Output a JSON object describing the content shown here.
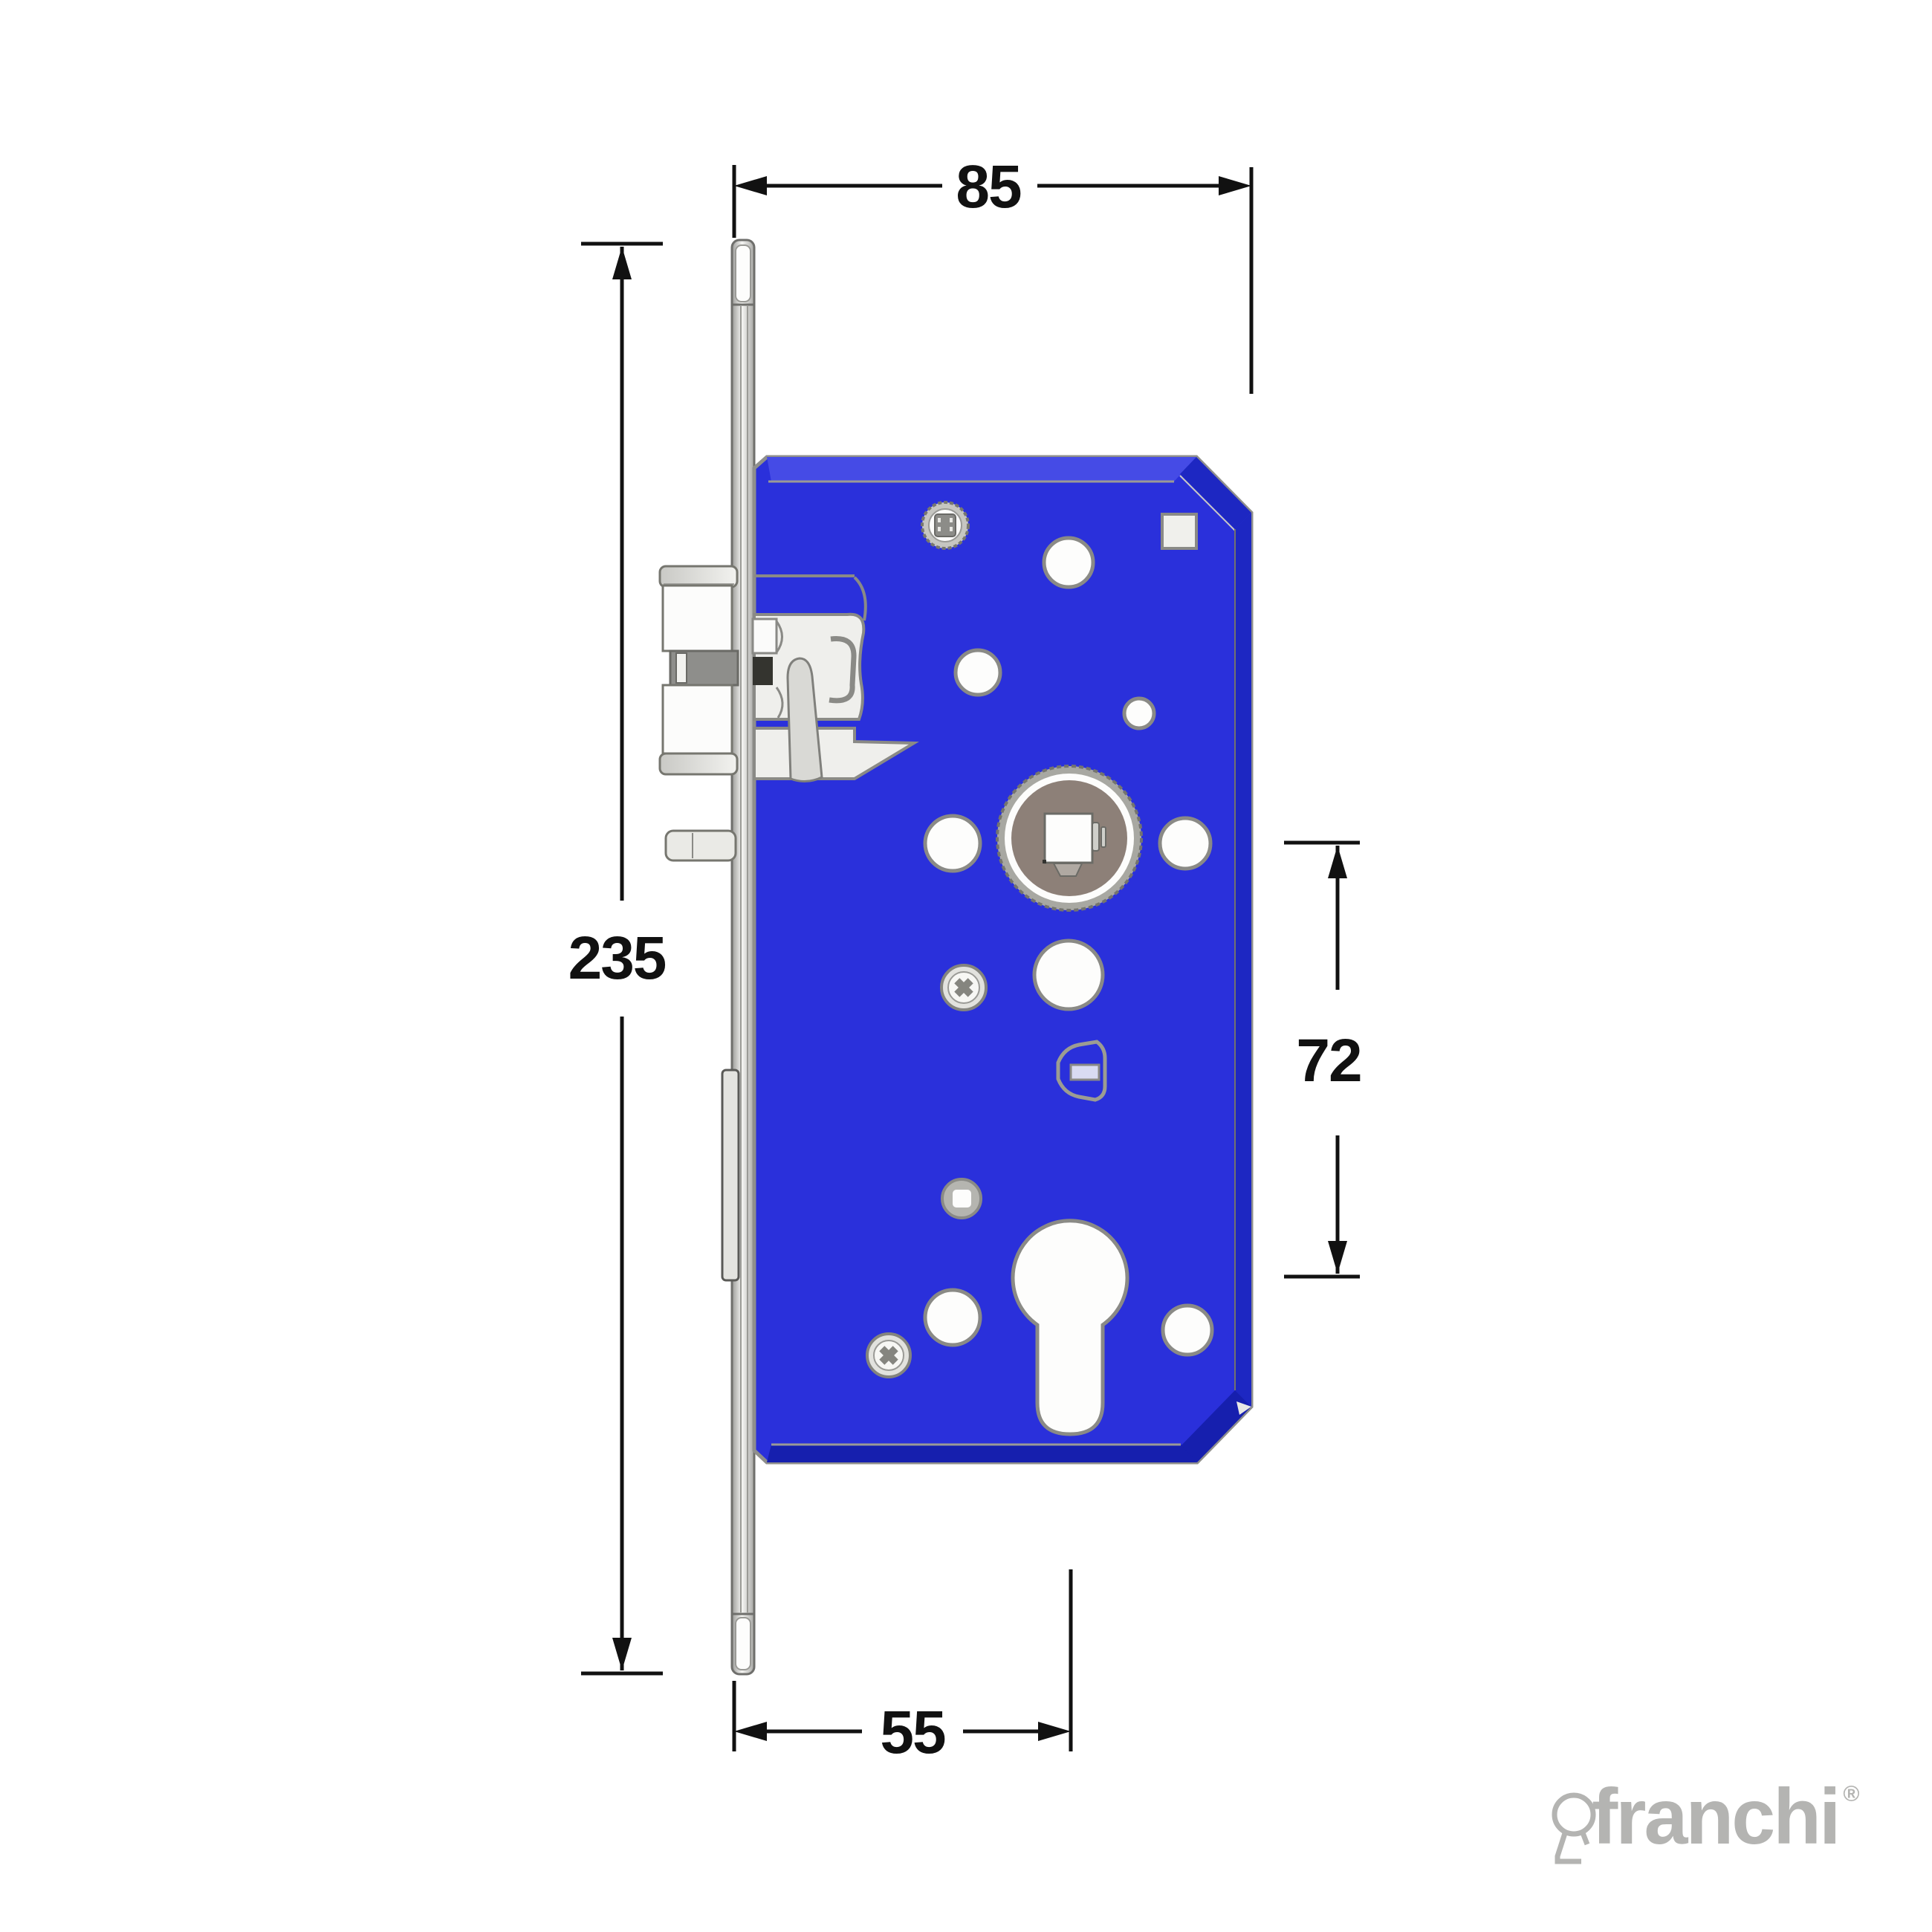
{
  "page": {
    "description": "Technical dimension drawing of a mortise door lock, side view, blue lock case"
  },
  "dimensions": {
    "case_width": {
      "value": "85"
    },
    "faceplate_height": {
      "value": "235"
    },
    "centre_distance": {
      "value": "72"
    },
    "backset": {
      "value": "55"
    }
  },
  "brand": {
    "wordmark": "franchi",
    "registered_mark": "®"
  },
  "icons": {
    "keyhole": "keyhole-icon"
  },
  "colors": {
    "body-blue": "#2a30db",
    "body-blue-light": "#454be6",
    "body-blue-dark": "#1d27c2",
    "body-blue-darker": "#161fae",
    "outline-gray": "#8a8a86",
    "metal-light": "#efefec",
    "metal-mid": "#c6c6c1",
    "metal-dark": "#8e8e8b",
    "hub-taupe": "#8d8078",
    "cylinder-insert-lavender": "#d9dbf2",
    "dimension-black": "#111111",
    "logo-gray": "#b4b4b2"
  }
}
